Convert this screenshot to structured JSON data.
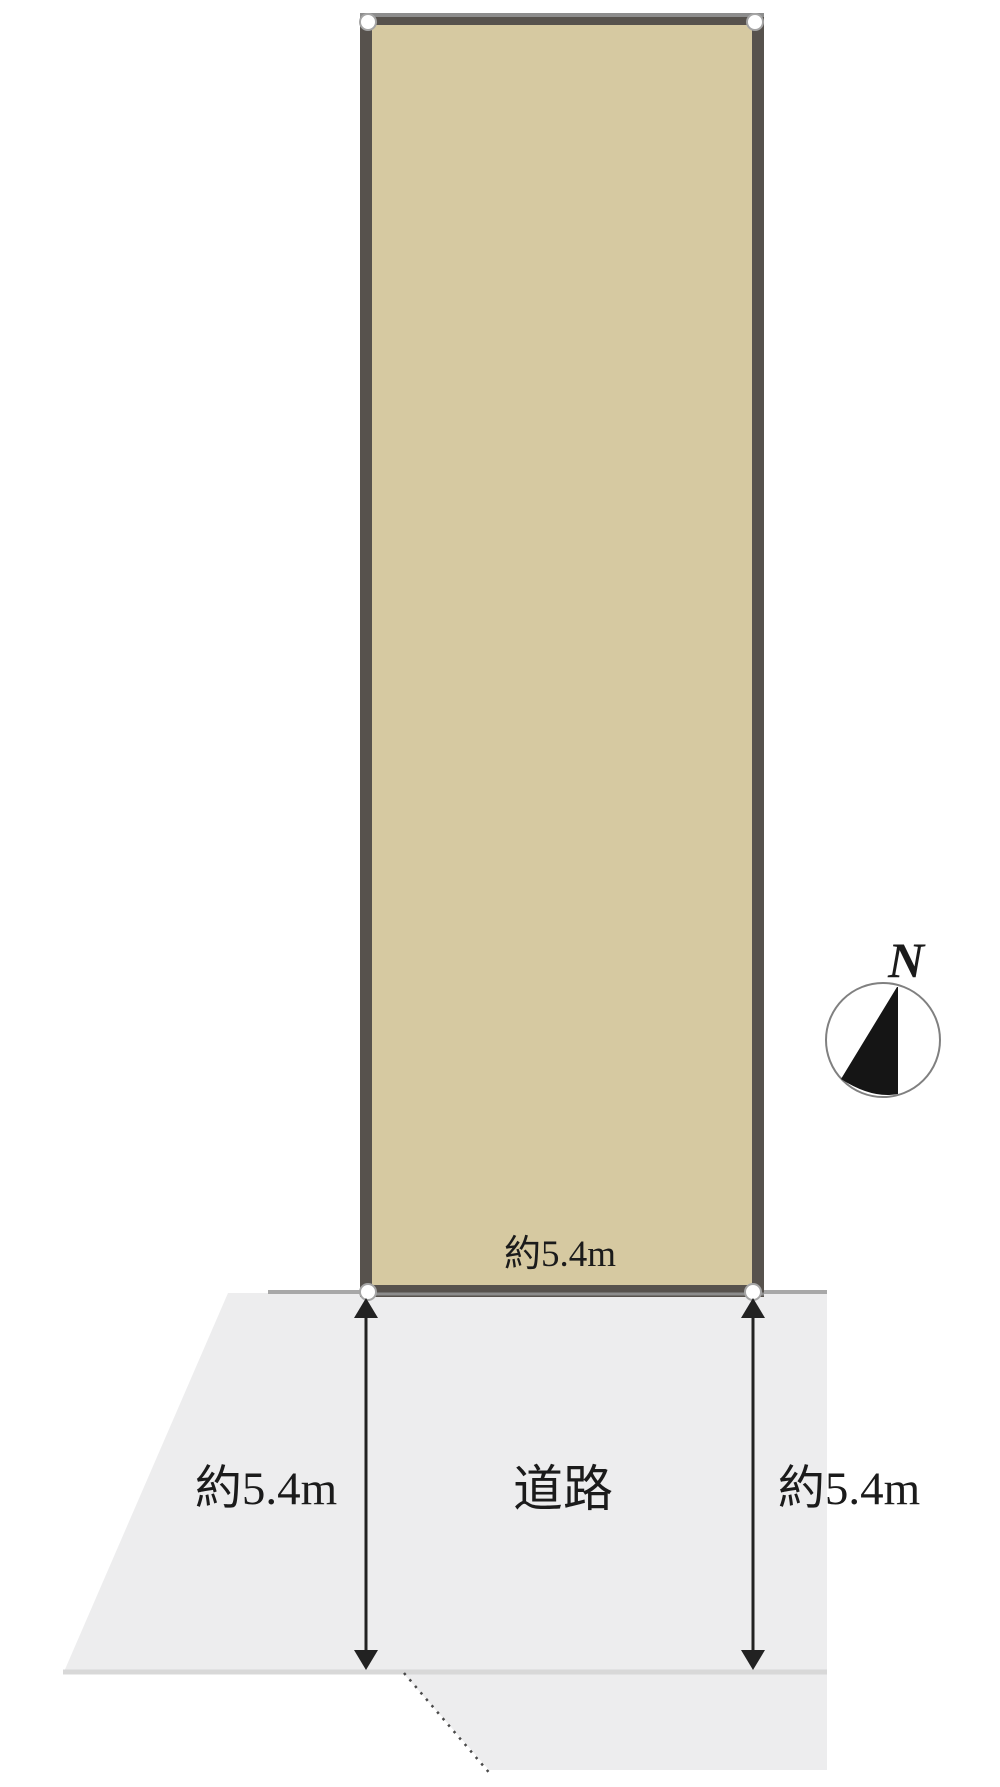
{
  "labels": {
    "parcel_frontage": "約5.4m",
    "road_name": "道路",
    "road_width_left": "約5.4m",
    "road_width_right": "約5.4m",
    "compass_north": "N"
  },
  "colors": {
    "background": "#ffffff",
    "parcel_fill": "#d6c9a1",
    "parcel_border": "#57524d",
    "parcel_border_highlight": "#8d8d8d",
    "road_fill": "#ededee",
    "boundary_line": "#a8a8a8",
    "road_edge_line": "#d8d8d8",
    "setback_dotted_line": "#4a4a4a",
    "arrow": "#222222",
    "corner_marker_fill": "#ffffff",
    "corner_marker_stroke": "#a5a5a5",
    "text": "#1b1b1b",
    "compass_stroke": "#808080",
    "compass_needle_fill": "#151515"
  }
}
